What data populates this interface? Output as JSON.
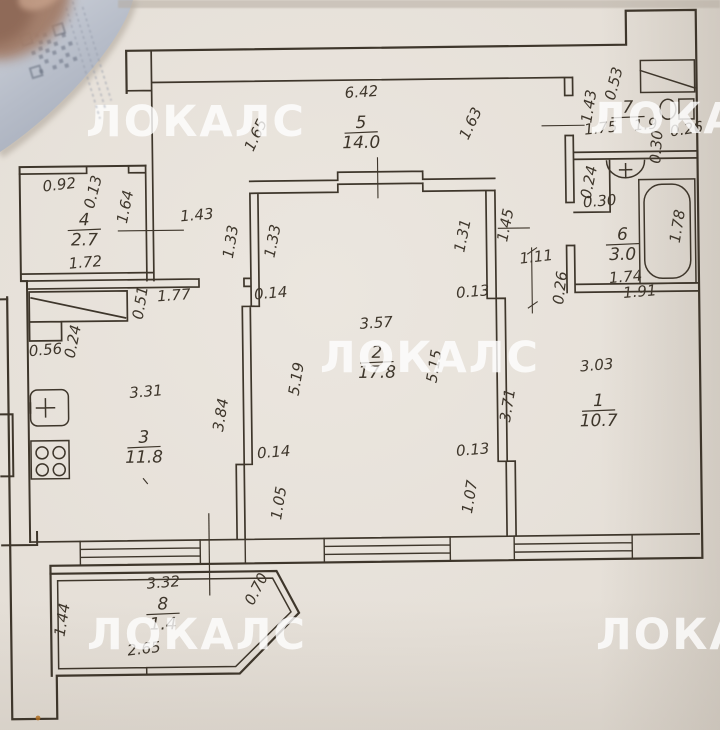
{
  "colors": {
    "paper": "#e4ded6",
    "ink": "#3e362b",
    "watermark": "#ffffff"
  },
  "watermark": {
    "text": "ЛОКАЛС",
    "positions": [
      {
        "x": 196,
        "y": 136
      },
      {
        "x": 700,
        "y": 133
      },
      {
        "x": 430,
        "y": 372
      },
      {
        "x": 197,
        "y": 649
      },
      {
        "x": 706,
        "y": 649
      }
    ]
  },
  "plan": {
    "rooms": [
      {
        "num": "5",
        "area": "14.0",
        "x": 364,
        "y": 128
      },
      {
        "num": "7",
        "area": "",
        "x": 631,
        "y": 116
      },
      {
        "num": "4",
        "area": "2.7",
        "x": 86,
        "y": 222
      },
      {
        "num": "6",
        "area": "3.0",
        "x": 624,
        "y": 243
      },
      {
        "num": "2",
        "area": "17.8",
        "x": 377,
        "y": 358
      },
      {
        "num": "1",
        "area": "10.7",
        "x": 598,
        "y": 409
      },
      {
        "num": "3",
        "area": "11.8",
        "x": 143,
        "y": 440
      },
      {
        "num": "8",
        "area": "1.4",
        "x": 160,
        "y": 607
      }
    ],
    "dimensions": [
      {
        "t": "6.42",
        "x": 365,
        "y": 97,
        "r": -3
      },
      {
        "t": "1.65",
        "x": 263,
        "y": 136,
        "r": -64
      },
      {
        "t": "1.63",
        "x": 478,
        "y": 127,
        "r": -64
      },
      {
        "t": "1.43",
        "x": 597,
        "y": 110,
        "r": -80
      },
      {
        "t": "0.53",
        "x": 622,
        "y": 88,
        "r": -75
      },
      {
        "t": "1.75",
        "x": 604,
        "y": 136,
        "r": -5
      },
      {
        "t": "1.9",
        "x": 649,
        "y": 133,
        "r": -5
      },
      {
        "t": "0.26",
        "x": 690,
        "y": 138,
        "r": -8
      },
      {
        "t": "0.30",
        "x": 664,
        "y": 151,
        "r": -85
      },
      {
        "t": "0.24",
        "x": 596,
        "y": 186,
        "r": -78
      },
      {
        "t": "0.30",
        "x": 602,
        "y": 209,
        "r": -4
      },
      {
        "t": "1.78",
        "x": 684,
        "y": 231,
        "r": -80
      },
      {
        "t": "1.74",
        "x": 627,
        "y": 285,
        "r": -4
      },
      {
        "t": "1.91",
        "x": 641,
        "y": 300,
        "r": -4
      },
      {
        "t": "0.26",
        "x": 566,
        "y": 291,
        "r": -82
      },
      {
        "t": "1.45",
        "x": 512,
        "y": 228,
        "r": -78
      },
      {
        "t": "1.31",
        "x": 469,
        "y": 238,
        "r": -78
      },
      {
        "t": "1.11",
        "x": 538,
        "y": 264,
        "r": -6
      },
      {
        "t": "1.33",
        "x": 279,
        "y": 241,
        "r": -78
      },
      {
        "t": "1.33",
        "x": 237,
        "y": 241,
        "r": -80
      },
      {
        "t": "1.43",
        "x": 199,
        "y": 218,
        "r": -4
      },
      {
        "t": "0.92",
        "x": 62,
        "y": 186,
        "r": -6
      },
      {
        "t": "0.13",
        "x": 100,
        "y": 190,
        "r": -75
      },
      {
        "t": "1.64",
        "x": 132,
        "y": 205,
        "r": -78
      },
      {
        "t": "1.72",
        "x": 87,
        "y": 264,
        "r": -4
      },
      {
        "t": "0.51",
        "x": 146,
        "y": 301,
        "r": -80
      },
      {
        "t": "1.77",
        "x": 175,
        "y": 298,
        "r": -3
      },
      {
        "t": "0.14",
        "x": 272,
        "y": 297,
        "r": -4
      },
      {
        "t": "0.13",
        "x": 474,
        "y": 298,
        "r": -4
      },
      {
        "t": "3.57",
        "x": 377,
        "y": 328,
        "r": -3
      },
      {
        "t": "5.19",
        "x": 301,
        "y": 379,
        "r": -80
      },
      {
        "t": "5.15",
        "x": 439,
        "y": 368,
        "r": -80
      },
      {
        "t": "3.71",
        "x": 512,
        "y": 408,
        "r": -80
      },
      {
        "t": "3.03",
        "x": 597,
        "y": 373,
        "r": -4
      },
      {
        "t": "0.14",
        "x": 273,
        "y": 456,
        "r": -4
      },
      {
        "t": "0.13",
        "x": 472,
        "y": 456,
        "r": -4
      },
      {
        "t": "1.05",
        "x": 282,
        "y": 503,
        "r": -80
      },
      {
        "t": "1.07",
        "x": 473,
        "y": 499,
        "r": -80
      },
      {
        "t": "0.56",
        "x": 46,
        "y": 351,
        "r": -4
      },
      {
        "t": "0.24",
        "x": 78,
        "y": 339,
        "r": -78
      },
      {
        "t": "3.31",
        "x": 146,
        "y": 394,
        "r": -4
      },
      {
        "t": "3.84",
        "x": 225,
        "y": 414,
        "r": -80
      },
      {
        "t": "3.32",
        "x": 161,
        "y": 585,
        "r": -4
      },
      {
        "t": "1.44",
        "x": 64,
        "y": 617,
        "r": -80
      },
      {
        "t": "0.70",
        "x": 258,
        "y": 590,
        "r": -62
      },
      {
        "t": "2.65",
        "x": 141,
        "y": 651,
        "r": -6
      }
    ]
  }
}
